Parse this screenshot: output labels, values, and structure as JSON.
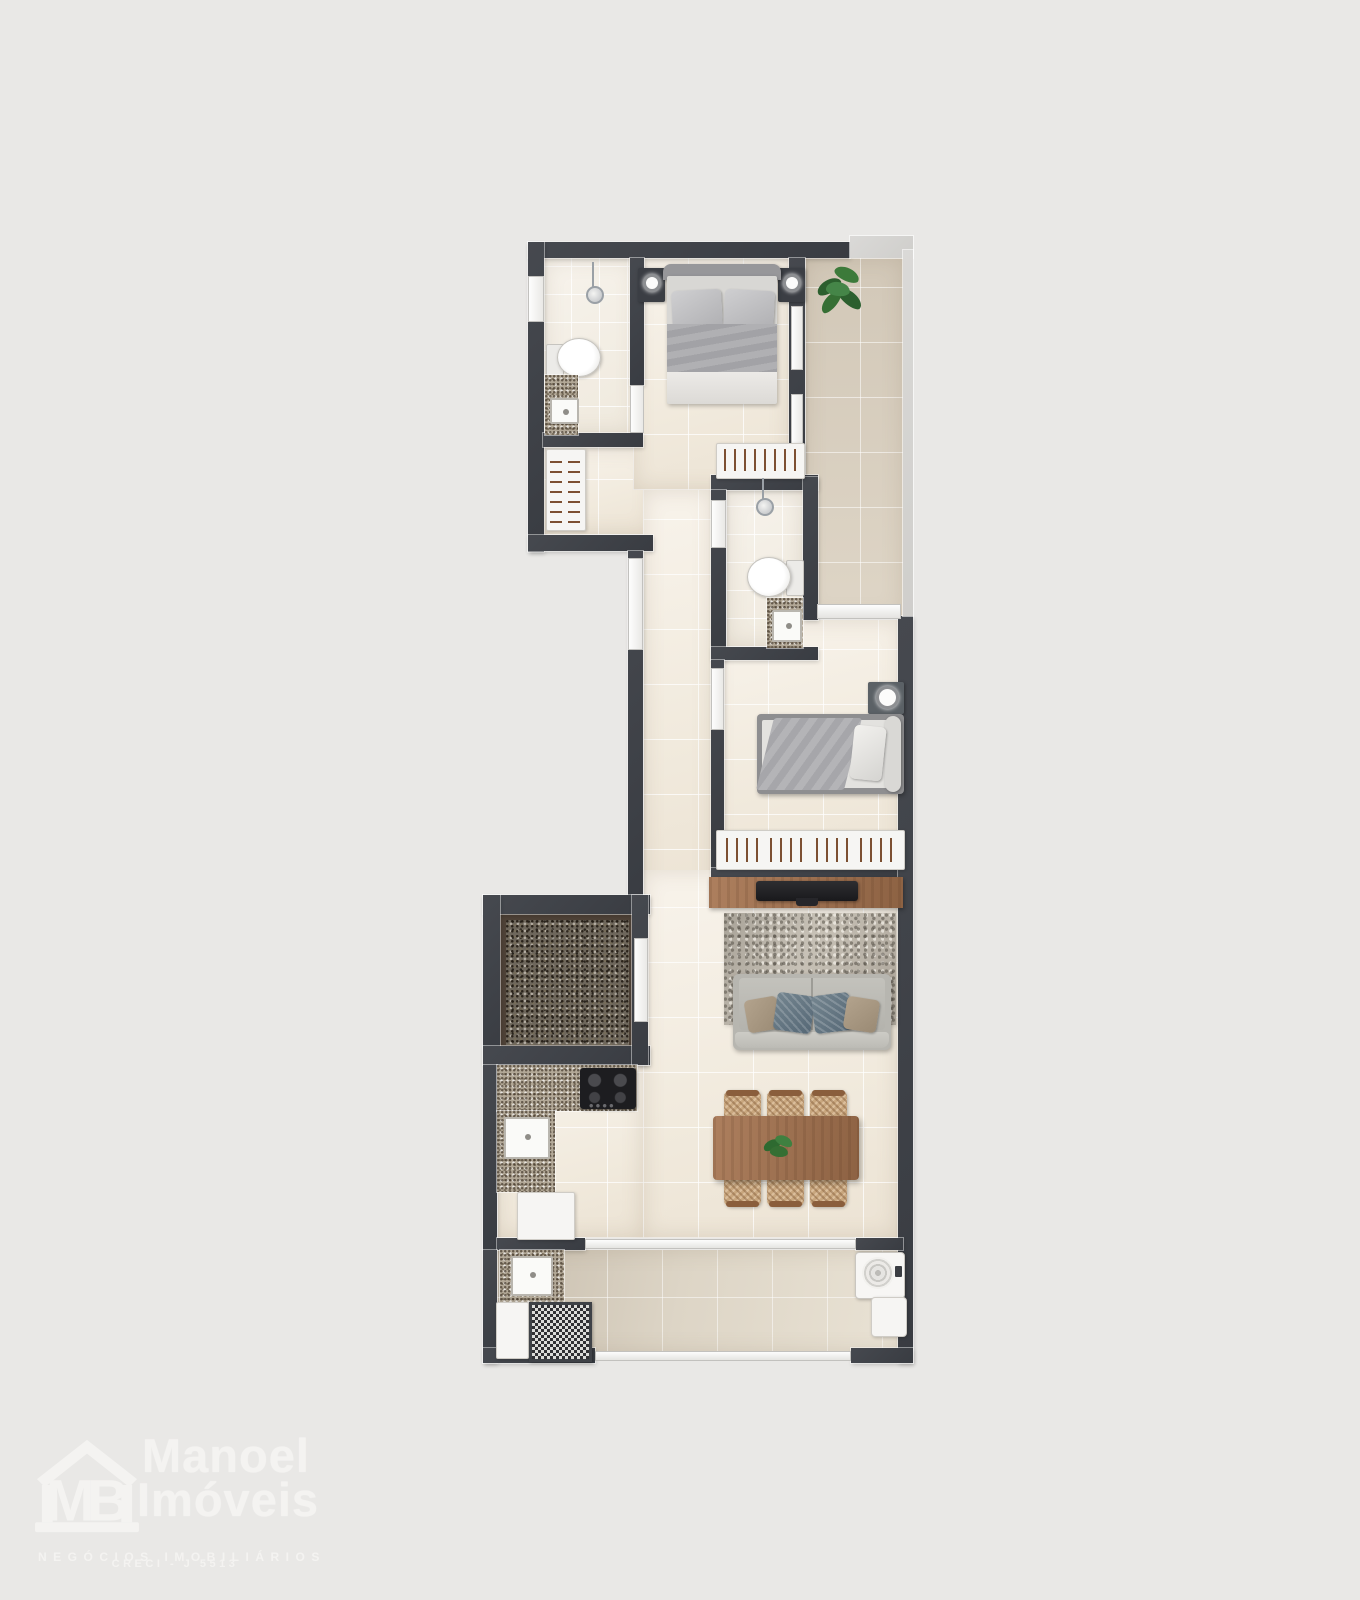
{
  "watermark": {
    "initials": "MB",
    "name_line1": "Manoel",
    "name_line2": "Imóveis",
    "tagline": "NEGÓCIOS IMOBILIÁRIOS",
    "registration": "CRECI - J 5513"
  },
  "floorplan": {
    "type": "apartment top-view 3D render",
    "rooms": [
      {
        "name": "suite-bathroom",
        "features": [
          "toilet",
          "granite-vanity-with-sink",
          "pendant-light",
          "window"
        ]
      },
      {
        "name": "suite-closet",
        "features": [
          "wardrobe-with-hanging-rails"
        ]
      },
      {
        "name": "master-bedroom",
        "features": [
          "double-bed",
          "two-nightstands-with-lamps",
          "wardrobe-with-hanging-rails"
        ]
      },
      {
        "name": "balcony",
        "features": [
          "potted-plant",
          "glass-railing",
          "sliding-glass-doors"
        ]
      },
      {
        "name": "social-bathroom",
        "features": [
          "toilet",
          "granite-vanity-with-sink",
          "pendant-light"
        ]
      },
      {
        "name": "second-bedroom",
        "features": [
          "single-bed",
          "nightstand-with-lamp",
          "wardrobe-with-hanging-rails"
        ]
      },
      {
        "name": "living-room",
        "features": [
          "tv-stand",
          "tv",
          "area-rug",
          "sofa",
          "four-pillows"
        ]
      },
      {
        "name": "dining-area",
        "features": [
          "wood-dining-table",
          "six-wicker-chairs",
          "table-plant"
        ]
      },
      {
        "name": "kitchen",
        "features": [
          "granite-countertop",
          "four-burner-cooktop",
          "sink",
          "refrigerator"
        ]
      },
      {
        "name": "entry-hall",
        "features": [
          "dark-granite-floor",
          "door"
        ]
      },
      {
        "name": "service-area",
        "features": [
          "granite-counter-with-sink",
          "washing-machine",
          "laundry-tank",
          "white-appliance",
          "service-door",
          "glass-sliding-door"
        ]
      }
    ]
  },
  "palette": {
    "background": "#e9e8e6",
    "wall": "#40434a",
    "floor_cream": "#f3eee5",
    "floor_balcony": "#d8cfc0",
    "floor_service": "#d4cabb",
    "granite_dark": "#6e675c",
    "granite_light": "#b2a897",
    "wood": "#a0734f",
    "plant_green": "#2f6b33",
    "sofa_gray": "#b7b6b0",
    "pillow_blue": "#60717f",
    "pillow_beige": "#a89684",
    "watermark_white": "#f4f3f1"
  }
}
